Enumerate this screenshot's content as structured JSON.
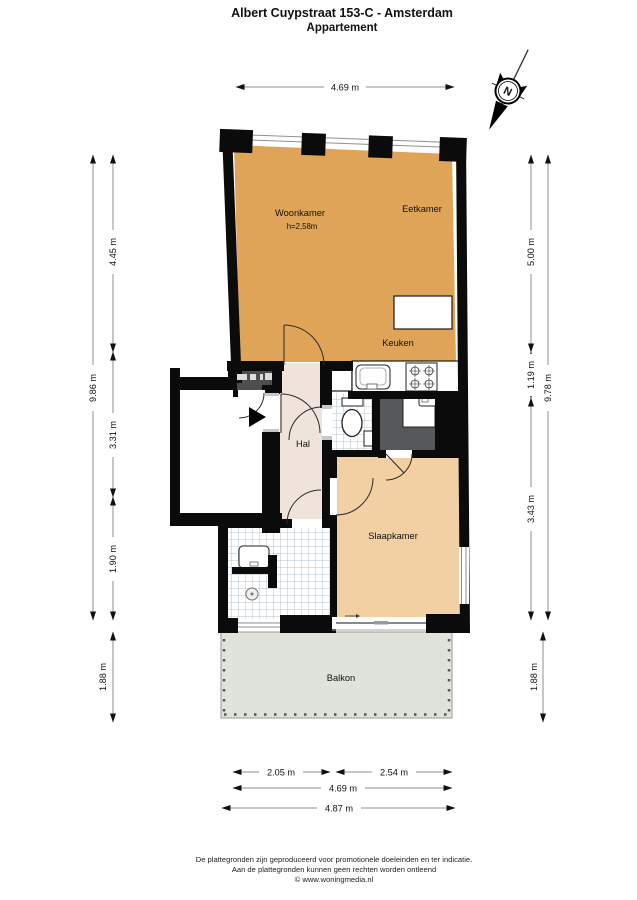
{
  "title": {
    "line1": "Albert Cuypstraat 153-C - Amsterdam",
    "line2": "Appartement"
  },
  "compass": {
    "label": "N"
  },
  "labels": {
    "woonkamer": "Woonkamer",
    "woonkamer_height": "h=2,58m",
    "eetkamer": "Eetkamer",
    "keuken": "Keuken",
    "hal": "Hal",
    "slaapkamer": "Slaapkamer",
    "balkon": "Balkon"
  },
  "dims": {
    "top": "4.69 m",
    "left_total": "9.86 m",
    "left_1": "4.45 m",
    "left_2": "3.31 m",
    "left_3": "1.90 m",
    "left_balcony": "1.88 m",
    "right_1": "5.00 m",
    "right_2": "1.19 m",
    "right_3": "3.43 m",
    "right_total": "9.78 m",
    "right_balcony": "1.88 m",
    "bottom_left": "2.05 m",
    "bottom_right": "2.54 m",
    "bottom_inner": "4.69 m",
    "bottom_outer": "4.87 m"
  },
  "footer": {
    "line1": "De plattegronden zijn geproduceerd voor promotionele doeleinden en ter indicatie.",
    "line2": "Aan de plattegronden kunnen geen rechten worden ontleend",
    "line3": "© www.woningmedia.nl"
  },
  "colors": {
    "living": "#DFA458",
    "bedroom": "#F2D0A4",
    "hall": "#EFE3DC",
    "balcony": "#E0E3DC",
    "dark_room": "#57585A",
    "meter_closet": "#4D4E50",
    "wall": "#0B0B0B",
    "tile_line": "#B3C3CD",
    "dim_line": "#8F8F8F"
  }
}
